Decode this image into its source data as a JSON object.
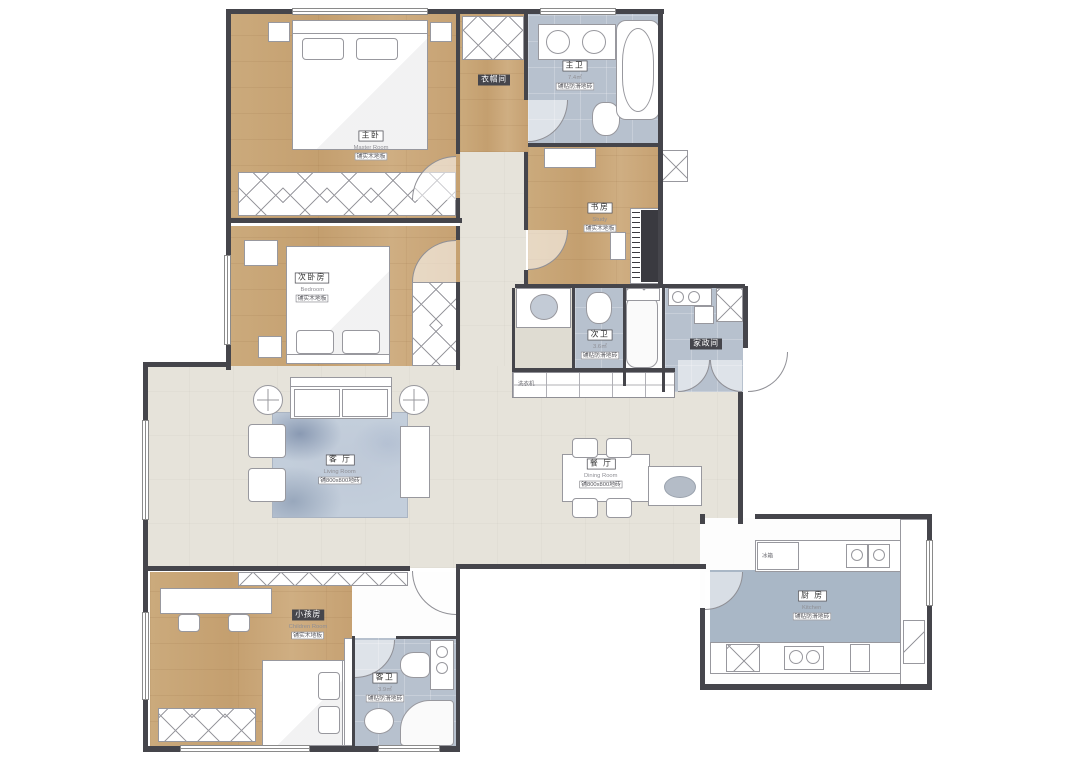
{
  "plan_title": "residential floor plan",
  "colors": {
    "wood_floor": "#c9a678",
    "tile_floor": "#b7c1ce",
    "main_floor": "#e6e3da",
    "wall": "#45454b",
    "rug": "#c3cedb"
  },
  "rooms": {
    "master_bedroom": {
      "name": "主卧",
      "en": "Master Room",
      "note": "铺实木地板"
    },
    "walk_in_closet": {
      "name": "衣帽间"
    },
    "master_bath": {
      "name": "主卫",
      "area": "7.4㎡",
      "note": "铺贴防滑地砖"
    },
    "study": {
      "name": "书房",
      "en": "Study",
      "note": "铺实木地板"
    },
    "second_bedroom": {
      "name": "次卧房",
      "en": "Bedroom",
      "note": "铺实木地板"
    },
    "living_room": {
      "name": "客 厅",
      "en": "Living Room",
      "note": "铺800x800地砖"
    },
    "dining_room": {
      "name": "餐 厅",
      "en": "Dining Room",
      "note": "铺800x800地砖"
    },
    "guest_bath": {
      "name": "次卫",
      "area": "3.6㎡",
      "note": "铺贴防滑地砖"
    },
    "utility": {
      "name": "家政间"
    },
    "kitchen": {
      "name": "厨 房",
      "en": "Kitchen",
      "note": "铺贴防滑地砖"
    },
    "kids_room": {
      "name": "小孩房",
      "en": "Children Room",
      "note": "铺实木地板"
    },
    "kids_bath": {
      "name": "客卫",
      "area": "3.9㎡",
      "note": "铺贴防滑地砖"
    }
  },
  "annotations": {
    "fridge": "冰箱",
    "washer": "洗衣机"
  }
}
